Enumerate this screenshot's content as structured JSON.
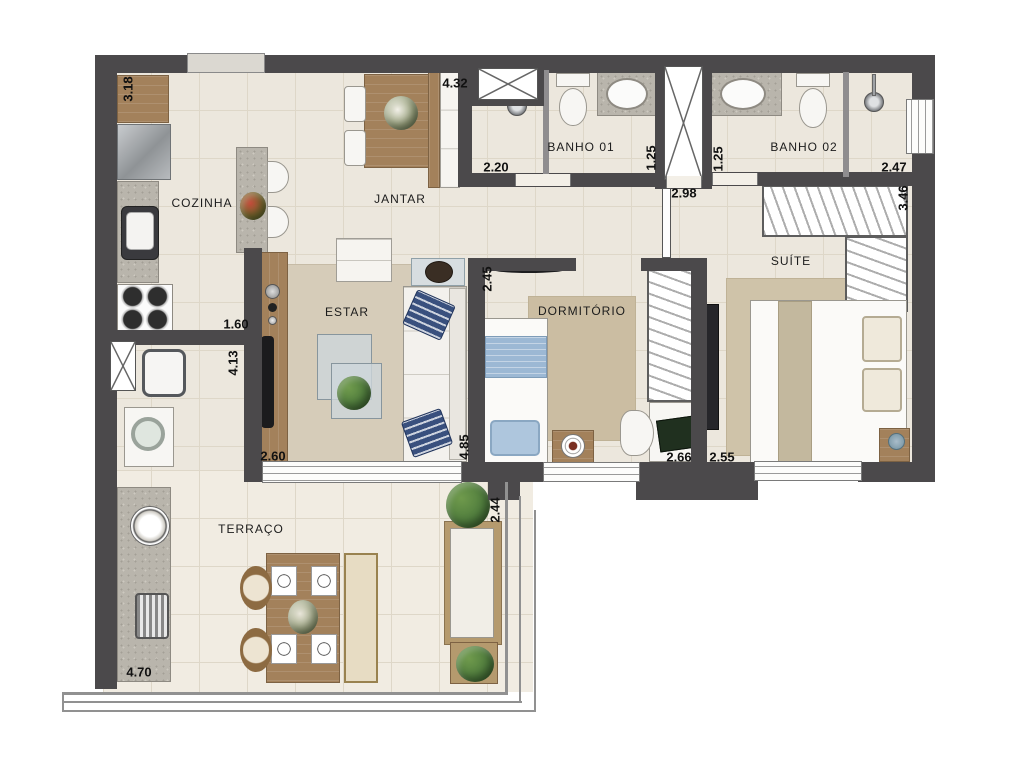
{
  "plan_title": "apartment-floor-plan",
  "rooms": {
    "cozinha": "COZINHA",
    "jantar": "JANTAR",
    "banho1": "BANHO 01",
    "banho2": "BANHO 02",
    "suite": "SUÍTE",
    "estar": "ESTAR",
    "dormitorio": "DORMITÓRIO",
    "terraco": "TERRAÇO"
  },
  "dims": {
    "cozinha_len": "3.18",
    "jantar_w": "4.32",
    "banho1_w": "2.20",
    "banho1_len": "1.25",
    "hall_w": "2.98",
    "banho2_len": "1.25",
    "banho2_w": "2.47",
    "suite_len": "3.46",
    "dorm_len": "2.45",
    "cozinha_w": "1.60",
    "service_len": "4.13",
    "estar_w": "2.60",
    "estar_len": "4.85",
    "dorm_w": "2.66",
    "suite_w": "2.55",
    "terraco_len": "2.44",
    "terraco_w": "4.70"
  },
  "colors": {
    "wall": "#4b494b",
    "floor_tile": "#ece7dd",
    "carpet": "#d6ccb9",
    "wood": "#a3815b",
    "granite": "#b9b5ac",
    "accent_blue": "#9cb8d4",
    "pillow_navy": "#39507e",
    "plant_green": "#4d7a3c"
  }
}
